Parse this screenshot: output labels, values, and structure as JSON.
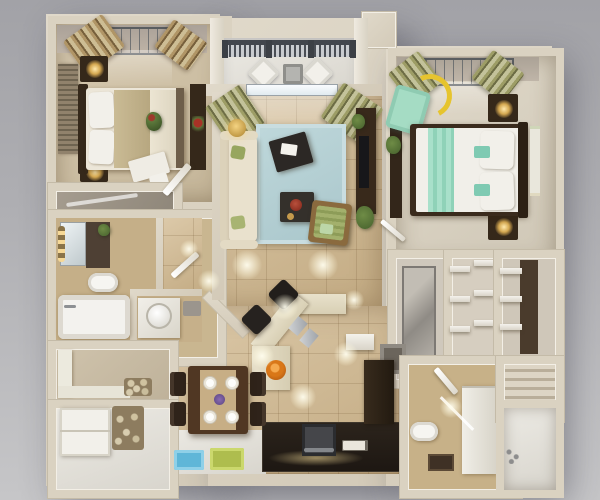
{
  "scene": {
    "type": "3d-floor-plan-render",
    "description": "Top-down 3D rendering of a two-bedroom apartment floor plan on a gray studio background. No text labels are present in the image.",
    "view": "top-down isometric render"
  },
  "palette": {
    "background_top": "#a2a2a7",
    "background_bottom": "#c6c6c8",
    "wall_cream": "#d8d0c0",
    "wall_highlight": "#f3efe6",
    "tile_floor": "#ccb58e",
    "bedroom_carpet": "#cfc2ab",
    "rug_blue": "#b6d1d5",
    "sofa_cream": "#e6ddc8",
    "accent_mint": "#9fd9c2",
    "accent_green": "#9dab66",
    "dark_wood": "#35281a",
    "kitchen_counter_dark": "#241d16",
    "lamp_gold": "#eec169",
    "arc_lamp_yellow": "#e6c42e",
    "bowl_orange": "#d97718",
    "mat_blue": "#5fb6d8",
    "mat_green": "#aebd4e",
    "railing_gray": "#42464d",
    "bowl_red": "#952e20"
  },
  "rooms": {
    "bedroom_left": {
      "label": "Bedroom 1 (top left)",
      "items": [
        "double bed with beige and cream bedding",
        "dark headboard",
        "two nightstands with lit gold lamps",
        "louvered wardrobe",
        "dresser with red flowers",
        "window with tan striped curtains",
        "white vanity desk and chair"
      ]
    },
    "balcony": {
      "label": "Balcony",
      "items": [
        "gray baluster railing",
        "two white chairs",
        "small gray table"
      ]
    },
    "living_room": {
      "label": "Living room",
      "items": [
        "cream three-seat sofa with green pillows",
        "light blue area rug",
        "two dark coffee tables with papers and red bowl",
        "green cushioned armchair",
        "gold floor lamp",
        "dark TV console with plants",
        "sliding door to balcony with olive striped curtains"
      ]
    },
    "bedroom_right": {
      "label": "Bedroom 2 (top right)",
      "items": [
        "double bed with white duvet and mint runner",
        "dark headboard on right wall",
        "two nightstands with lit lamps",
        "mint armchair",
        "yellow arc floor lamp",
        "window with olive striped curtains",
        "framed artwork",
        "dark shelf with plant"
      ]
    },
    "bathroom_main": {
      "label": "Main bathroom (left)",
      "items": [
        "vanity with lit mirror",
        "dark cabinet",
        "toilet",
        "bathtub"
      ]
    },
    "wc": {
      "label": "Powder room",
      "items": [
        "white counter with round vessel sink",
        "gray bath mat",
        "chamfered corner wall"
      ]
    },
    "hallway": {
      "label": "Hallway",
      "items": [
        "white swing doors",
        "potted plant"
      ]
    },
    "entry": {
      "label": "Entry nook",
      "items": [
        "white L-shaped bench",
        "pebble decor"
      ]
    },
    "laundry": {
      "label": "Laundry / storage",
      "items": [
        "white stacked cabinets",
        "pebble decor shelf"
      ]
    },
    "dining": {
      "label": "Dining area",
      "items": [
        "dark wood table",
        "four place settings with white plates",
        "purple centerpiece",
        "four dark chairs",
        "blue floor mat",
        "green floor mat"
      ]
    },
    "kitchen": {
      "label": "Kitchen",
      "items": [
        "angled cream breakfast bar",
        "two dark bar stools",
        "orange fruit bowl",
        "gray placemats",
        "dark L-shaped counter with stove",
        "tall dark cabinet",
        "white wall shelf",
        "power outlets"
      ]
    },
    "closet_corridor": {
      "label": "Closet corridor (right)",
      "items": [
        "mirrored-door closet",
        "walk-in closet with white shelves",
        "wardrobe with shelves",
        "small gray-top cabinet"
      ]
    },
    "bathroom_second": {
      "label": "Second bathroom (bottom right)",
      "items": [
        "toilet",
        "shower floor with dark drain",
        "white vanity cabinets",
        "glass partition",
        "white door"
      ]
    },
    "shower_room": {
      "label": "Tub room (bottom right corner)",
      "items": [
        "white bathtub area",
        "wall faucet fittings"
      ]
    },
    "small_closet": {
      "label": "Linen closet",
      "items": [
        "slatted shelves"
      ]
    }
  }
}
